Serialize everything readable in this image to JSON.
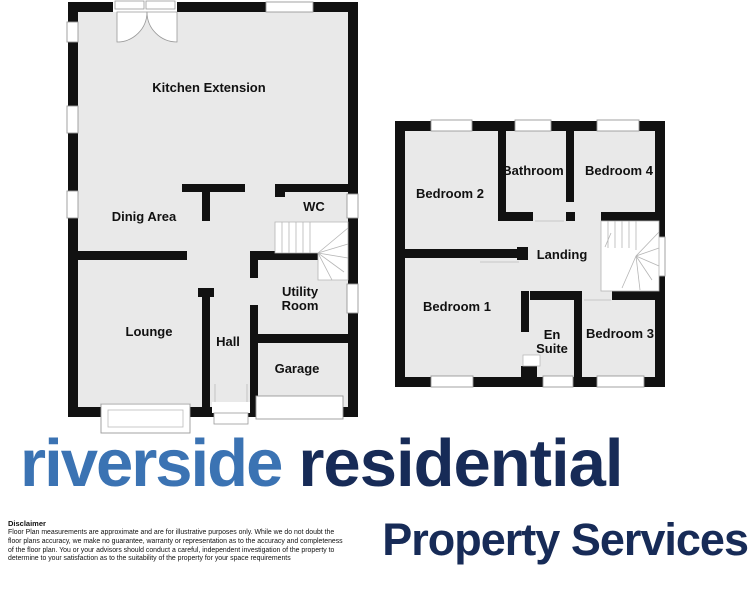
{
  "brand": {
    "word1": "riverside",
    "word2": "residential",
    "line2": "Property Services",
    "blue": "#3b73b3",
    "navy": "#172b57"
  },
  "disclaimer": {
    "title": "Disclaimer",
    "body": "Floor Plan measurements are approximate and are for illustrative purposes only. While we do not doubt the floor plans accuracy, we make no guarantee, warranty or representation as to the accuracy and completeness of the floor plan. You or your advisors should conduct a careful, independent investigation of the property to determine to your satisfaction as to the suitability of the property for your space requirements",
    "text_color": "#111111"
  },
  "floorplan_colors": {
    "floor_fill": "#e9e9e9",
    "wall": "#111111",
    "window_frame": "#999999",
    "stair_line": "#b5b5b5"
  },
  "ground_floor": {
    "kitchen": "Kitchen Extension",
    "dining": "Dinig Area",
    "wc": "WC",
    "utility_line1": "Utility",
    "utility_line2": "Room",
    "lounge": "Lounge",
    "hall": "Hall",
    "garage": "Garage"
  },
  "first_floor": {
    "bedroom2": "Bedroom 2",
    "bathroom": "Bathroom",
    "bedroom4": "Bedroom 4",
    "landing": "Landing",
    "bedroom1": "Bedroom 1",
    "ensuite_line1": "En",
    "ensuite_line2": "Suite",
    "bedroom3": "Bedroom 3"
  }
}
